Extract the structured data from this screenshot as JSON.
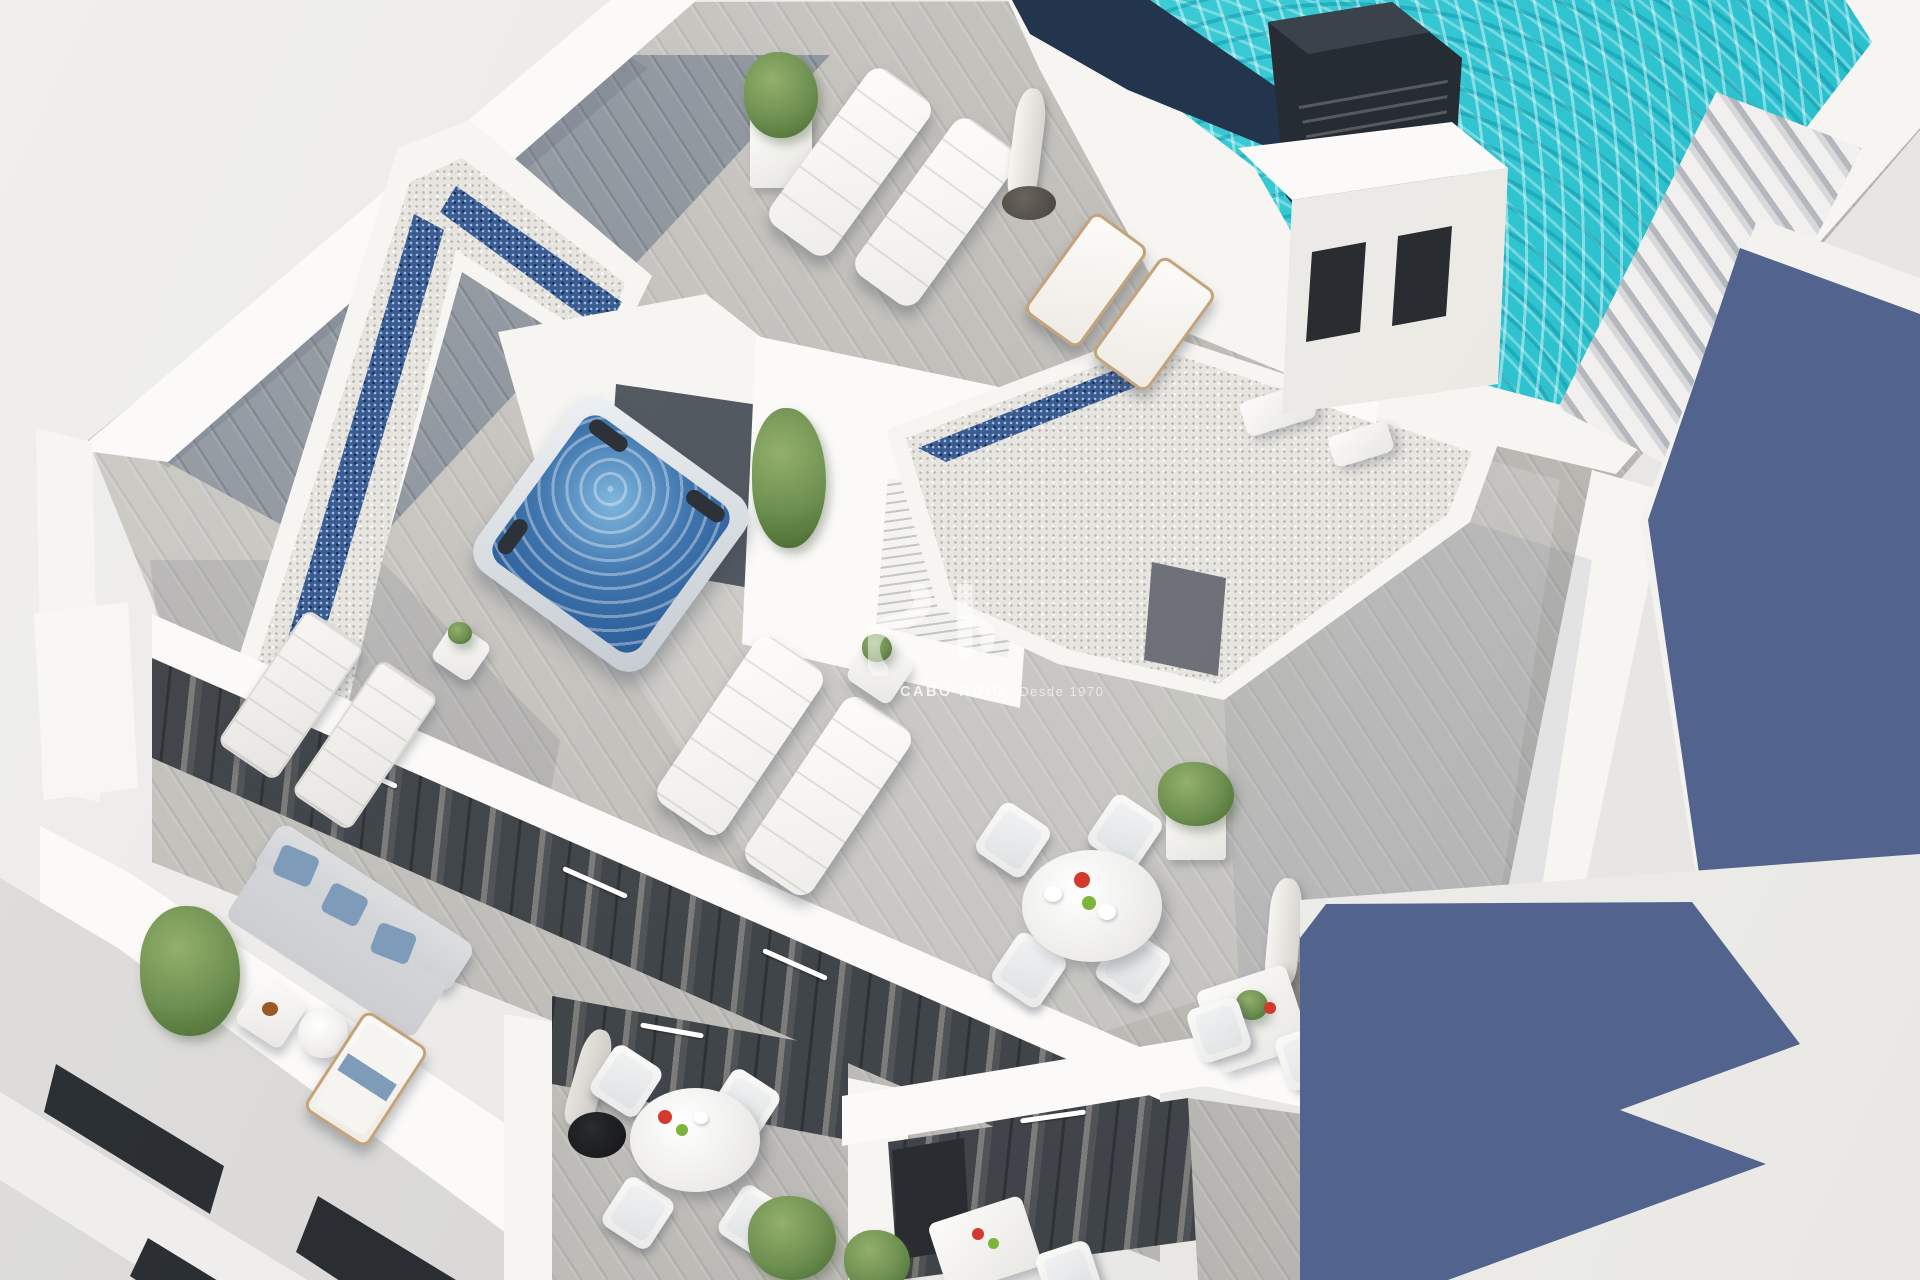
{
  "meta": {
    "type": "3d-architectural-render",
    "subject": "Aerial view of a modern white apartment building rooftop solarium with pool, hot tub and terraces"
  },
  "watermark": {
    "brand": "CABO ROIG",
    "tagline": "Desde 1970"
  },
  "palette": {
    "bg": "#e9e8e6",
    "wall": "#f6f5f2",
    "wallBright": "#fbfaf8",
    "wallShade": "#e7e5e1",
    "deckLight": "#c9c7c2",
    "deckDark": "#8f959d",
    "pool": "#35ccd4",
    "poolDeep": "#1cb6c6",
    "navy": "#22354d",
    "shadowBlue": "#52648e",
    "gravel": "#e7e5e0",
    "glassBlue": "#3b5c90",
    "facade": "#3f4449",
    "windowDark": "#26292d",
    "chimney": "#262c33",
    "plant": "#6d8f50",
    "plantDark": "#49682f",
    "tubWater": "#3f74ad",
    "nicheFloor": "#4e545b",
    "frameTan": "#c5a379",
    "sofa": "#ccced1",
    "pillow": "#7e9cba",
    "accentRed": "#d23a2e",
    "accentGreen": "#7fb43a",
    "earth": "#8a7a66",
    "stairShade": "#b4b8bd",
    "curtain": "#a9a49c"
  },
  "features": [
    "swimming-pool",
    "pool-stairs",
    "chimney-vent",
    "pool-house",
    "gravel-roof-with-blue-glass-border",
    "hot-tub",
    "plush-sun-loungers",
    "wooden-deck-chairs",
    "closed-parasols",
    "round-dining-tables",
    "square-bistro-tables",
    "outdoor-sofa-with-blue-pillows",
    "potted-plants",
    "dark-glass-facades",
    "balconies",
    "neighbor-building-with-blue-shadow",
    "timber-deck-flooring"
  ]
}
